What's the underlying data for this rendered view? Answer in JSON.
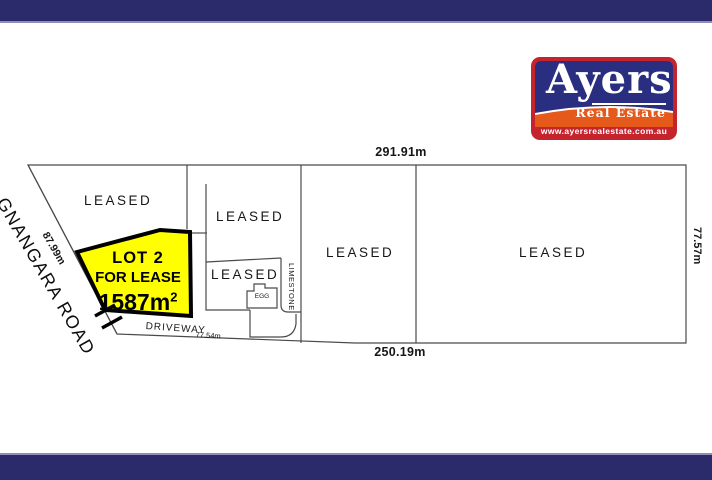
{
  "theme": {
    "bar_navy": "#2b2a6b",
    "bar_accent": "#8f8cbe",
    "plan_line_color": "#4a4a4a",
    "text_color": "#161616"
  },
  "logo": {
    "brand": "Ayers",
    "tagline": "Real Estate",
    "website": "www.ayersrealestate.com.au",
    "colors": {
      "red": "#c5242c",
      "navy": "#2a2e80",
      "orange": "#e5591a",
      "text": "#ffffff"
    }
  },
  "plan": {
    "road": {
      "name": "GNANGARA ROAD",
      "frontage": "87.99m"
    },
    "measurements": {
      "top_boundary": "291.91m",
      "bottom_boundary": "250.19m",
      "right_boundary": "77.57m",
      "driveway": "77.54m"
    },
    "lot": {
      "title": "LOT 2",
      "subtitle": "FOR LEASE",
      "area": "1587m",
      "area_superscript": "2",
      "fill": "#ffff00"
    },
    "parcels": [
      {
        "label": "LEASED"
      },
      {
        "label": "LEASED"
      },
      {
        "label": "LEASED"
      },
      {
        "label": "LEASED"
      },
      {
        "label": "LEASED"
      }
    ],
    "driveway_label": "DRIVEWAY",
    "limestone_label": "LIMESTONE",
    "building_label": "EGG"
  }
}
